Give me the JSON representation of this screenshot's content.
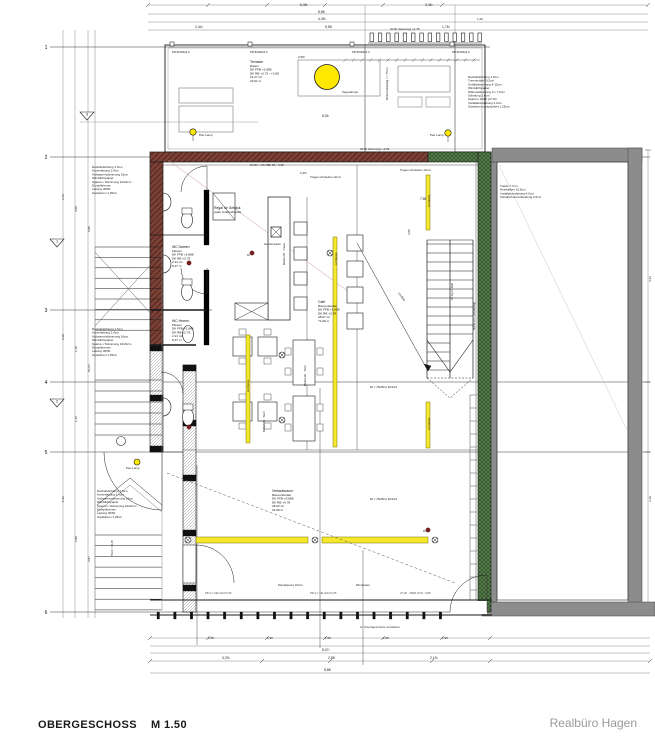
{
  "footer": {
    "sheet_title": "OBERGESCHOSS",
    "sheet_scale": "M 1.50",
    "firm": "Realbüro Hagen"
  },
  "colors": {
    "yellow": "#f5e82e",
    "lamp_yellow": "#ffe800",
    "brick": "#7c4136",
    "green": "#5b824f",
    "wall_gray": "#8c8c8c",
    "red_dot": "#7a1f1f"
  },
  "axis_rows": [
    {
      "n": "1",
      "y": 47,
      "x1": 50,
      "x2": 490
    },
    {
      "n": "2",
      "y": 157,
      "x1": 50,
      "x2": 650
    },
    {
      "n": "3",
      "y": 310,
      "x1": 50,
      "x2": 212
    },
    {
      "n": "4",
      "y": 382,
      "x1": 50,
      "x2": 650
    },
    {
      "n": "5",
      "y": 452,
      "x1": 50,
      "x2": 650
    },
    {
      "n": "6",
      "y": 612,
      "x1": 50,
      "x2": 650
    }
  ],
  "detail_markers": [
    {
      "n": "3",
      "x": 87,
      "y": 116
    },
    {
      "n": "1",
      "x": 57,
      "y": 243
    },
    {
      "n": "2",
      "x": 57,
      "y": 403
    }
  ],
  "room_stamps": [
    {
      "x": 250,
      "y": 63,
      "lines": [
        "Terrasse",
        "Dielen",
        "DK FFB +2.888",
        "DK RB +2.73 - +2.88",
        "21.27 m²",
        "22.01 m"
      ]
    },
    {
      "x": 172,
      "y": 248,
      "lines": [
        "WC Damen",
        "Fliesen",
        "DK FFB +2.888",
        "DK RB +2.79",
        "2.21 m²",
        "8.27 m"
      ]
    },
    {
      "x": 172,
      "y": 322,
      "lines": [
        "WC Herren",
        "Fliesen",
        "DK FFB +2.888",
        "DK RB +2.79",
        "2.21 m²",
        "8.27 m"
      ]
    },
    {
      "x": 318,
      "y": 303,
      "lines": [
        "Café",
        "Riemenboden",
        "DK FFB +2.888",
        "DK RB +2.79",
        "48.07 m²",
        "71.06 m"
      ]
    },
    {
      "x": 272,
      "y": 492,
      "lines": [
        "Verkaufsraum",
        "Riemenboden",
        "DK FFB +0.888",
        "DK RB +0.78",
        "28.22 m²",
        "31.90 m"
      ]
    },
    {
      "x": 214,
      "y": 209,
      "lines": [
        "Regal für Gebäck",
        "(statt Unterschrank)"
      ]
    }
  ],
  "spec_blocks": [
    {
      "x": 92,
      "y": 168,
      "lines": [
        "Dachabdichtung 1,5cm",
        "Konterlattung 2,4cm",
        "Aufsparrendämmung 16cm",
        "Winddichtpapier",
        "Sparren / Dämmung 10/22cm",
        "Dampfbremse",
        "Lattung 30/50",
        "Gipskarton 1,25cm"
      ]
    },
    {
      "x": 92,
      "y": 330,
      "lines": [
        "Dachabdichtung 1,5cm",
        "Konterlattung 2,4cm",
        "Aufsparrendämmung 16cm",
        "Winddichtpapier",
        "Sparren / Dämmung 10/22cm",
        "Dampfbremse",
        "Lattung 30/50",
        "Gipskarton 1,25cm"
      ]
    },
    {
      "x": 97,
      "y": 492,
      "lines": [
        "Dachabdichtung 1,5cm",
        "Konterlattung 2,4cm",
        "Aufsparrendämmung 16cm",
        "Winddichtpapier",
        "Sparren / Dämmung 10/22cm",
        "Dampfbremse",
        "Lattung 30/50",
        "Gipskarton 1,25cm"
      ]
    },
    {
      "x": 468,
      "y": 78,
      "lines": [
        "Dachabdichtung 1,5cm",
        "Trennschicht 0,2cm",
        "Gefälledämmung 4-12cm",
        "Winddichtpapier",
        "Wärmedämmung 2 x 7,0cm",
        "Schalung 2,4cm",
        "Sparren 10/20 (e=70)",
        "Installationslattung 4,0cm",
        "Gipskarton gespachtelt 1,25cm"
      ]
    },
    {
      "x": 500,
      "y": 187,
      "lines": [
        "Traufe 7,7cm",
        "Holzbalken 10,5cm",
        "Installationslattung 4,0cm",
        "Schallschutzverkleidung 2,5cm"
      ]
    }
  ],
  "labels": [
    {
      "t": "5,38¹",
      "x": 300,
      "y": 6,
      "s": 3.4
    },
    {
      "t": "3,46¹",
      "x": 425,
      "y": 6,
      "s": 3.4
    },
    {
      "t": "8,86",
      "x": 318,
      "y": 13,
      "s": 3.4
    },
    {
      "t": "4,05¹",
      "x": 318,
      "y": 20,
      "s": 3.4
    },
    {
      "t": "1,20",
      "x": 477,
      "y": 20,
      "s": 3
    },
    {
      "t": "2,44¹",
      "x": 195,
      "y": 28,
      "s": 3.4
    },
    {
      "t": "5,58",
      "x": 325,
      "y": 28,
      "s": 3.4
    },
    {
      "t": "1,76¹",
      "x": 442,
      "y": 28,
      "s": 3.4
    },
    {
      "t": "20 RI (Setzung) +2,78",
      "x": 390,
      "y": 30,
      "s": 3
    },
    {
      "t": "PR 80x80x2.0",
      "x": 172,
      "y": 53,
      "s": 2.8
    },
    {
      "t": "PR 80x80x2.0",
      "x": 250,
      "y": 53,
      "s": 2.8
    },
    {
      "t": "PR 80x80x2.0",
      "x": 352,
      "y": 53,
      "s": 2.8
    },
    {
      "t": "PR 80x80x2.0",
      "x": 452,
      "y": 53,
      "s": 2.8
    },
    {
      "t": "2,58¹",
      "x": 298,
      "y": 58,
      "s": 3
    },
    {
      "t": "Tageslampe",
      "x": 342,
      "y": 93,
      "s": 3
    },
    {
      "t": "Pan Lamp",
      "x": 199,
      "y": 136,
      "s": 3
    },
    {
      "t": "Pan Lamp",
      "x": 430,
      "y": 136,
      "s": 3
    },
    {
      "t": "8,34¹",
      "x": 322,
      "y": 117,
      "s": 3.2
    },
    {
      "t": "Möbel beidseitig h = 75cm",
      "x": 388,
      "y": 100,
      "r": -90,
      "s": 2.8
    },
    {
      "t": "20 RI (Setzung) +2,82",
      "x": 360,
      "y": 150,
      "s": 3
    },
    {
      "t": "DI DK = OK OBF 25 = 6,58",
      "x": 250,
      "y": 166,
      "s": 2.8
    },
    {
      "t": "Tragen schrauben 12mm",
      "x": 310,
      "y": 178,
      "s": 2.8
    },
    {
      "t": "Tragen schrauben 12mm",
      "x": 400,
      "y": 171,
      "s": 2.8
    },
    {
      "t": "2,25¹",
      "x": 300,
      "y": 174,
      "s": 3
    },
    {
      "t": "7,58",
      "x": 420,
      "y": 200,
      "s": 3.2
    },
    {
      "t": "3,05",
      "x": 410,
      "y": 235,
      "r": -90,
      "s": 3
    },
    {
      "t": "Geschirrspüler",
      "x": 264,
      "y": 245,
      "s": 2.6
    },
    {
      "t": "Lauflinie",
      "x": 398,
      "y": 293,
      "r": 55,
      "s": 2.8
    },
    {
      "t": "Möbel 2D - Theke",
      "x": 285,
      "y": 265,
      "r": -90,
      "s": 2.8
    },
    {
      "t": "Lichtleiste",
      "x": 337,
      "y": 265,
      "r": -90,
      "s": 2.8
    },
    {
      "t": "Lichtleiste",
      "x": 430,
      "y": 207,
      "r": -90,
      "s": 2.8
    },
    {
      "t": "Lichtleiste",
      "x": 430,
      "y": 430,
      "r": -90,
      "s": 2.8
    },
    {
      "t": "Lichtleiste",
      "x": 249,
      "y": 392,
      "r": -90,
      "s": 2.8
    },
    {
      "t": "Möbel 2D - Tisch",
      "x": 306,
      "y": 386,
      "r": -90,
      "s": 2.8
    },
    {
      "t": "Möbel 2D - Tisch",
      "x": 265,
      "y": 432,
      "r": -90,
      "s": 2.8
    },
    {
      "t": "18 Stg 17,5/28",
      "x": 453,
      "y": 300,
      "r": -90,
      "s": 2.6
    },
    {
      "t": "Mörtel 10 lt. (Werkseitig)",
      "x": 475,
      "y": 330,
      "r": -90,
      "s": 2.6
    },
    {
      "t": "60 × 15/28cm 90/14/1",
      "x": 370,
      "y": 388,
      "s": 2.8
    },
    {
      "t": "60 × 15/28cm 90/14/1",
      "x": 370,
      "y": 500,
      "s": 2.8
    },
    {
      "t": "Pan Lamp",
      "x": 126,
      "y": 469,
      "s": 3
    },
    {
      "t": "5% R = 10,05",
      "x": 113,
      "y": 556,
      "r": -90,
      "s": 2.6
    },
    {
      "t": "60",
      "x": 247,
      "y": 256,
      "s": 2.4
    },
    {
      "t": "60",
      "x": 423,
      "y": 532,
      "s": 2.4
    },
    {
      "t": "Dampfsperre 10mm",
      "x": 278,
      "y": 586,
      "s": 2.8
    },
    {
      "t": "Rinnkasten",
      "x": 356,
      "y": 586,
      "s": 2.8
    },
    {
      "t": "PR st = 101.0x0.0 0.05",
      "x": 205,
      "y": 594,
      "s": 2.6,
      "c": "#444"
    },
    {
      "t": "PR st = 101.0x0.0 0.05",
      "x": 310,
      "y": 594,
      "s": 2.6,
      "c": "#444"
    },
    {
      "t": "27 UK - 25/05 N UK - 5,88",
      "x": 400,
      "y": 594,
      "s": 2.6,
      "c": "#444"
    },
    {
      "t": "im Kriechgeschoss verstärken",
      "x": 360,
      "y": 628,
      "s": 3,
      "c": "#333"
    },
    {
      "t": "1,55",
      "x": 208,
      "y": 639,
      "s": 3
    },
    {
      "t": "1,55",
      "x": 267,
      "y": 639,
      "s": 3
    },
    {
      "t": "1,55",
      "x": 325,
      "y": 639,
      "s": 3
    },
    {
      "t": "1,55",
      "x": 383,
      "y": 639,
      "s": 3
    },
    {
      "t": "1,55",
      "x": 442,
      "y": 639,
      "s": 3
    },
    {
      "t": "8,07¹",
      "x": 322,
      "y": 651,
      "s": 3.4
    },
    {
      "t": "3,29¹",
      "x": 222,
      "y": 659,
      "s": 3.4
    },
    {
      "t": "2,88",
      "x": 328,
      "y": 659,
      "s": 3.4
    },
    {
      "t": "2,19¹",
      "x": 430,
      "y": 659,
      "s": 3.4
    },
    {
      "t": "8,88",
      "x": 324,
      "y": 671,
      "s": 3.4
    },
    {
      "t": "3,72",
      "x": 64,
      "y": 200,
      "r": -90,
      "s": 3
    },
    {
      "t": "3,58",
      "x": 77,
      "y": 212,
      "r": -90,
      "s": 3
    },
    {
      "t": "6,88",
      "x": 90,
      "y": 232,
      "r": -90,
      "s": 3
    },
    {
      "t": "3,18",
      "x": 64,
      "y": 340,
      "r": -90,
      "s": 3
    },
    {
      "t": "1,18",
      "x": 77,
      "y": 352,
      "r": -90,
      "s": 3
    },
    {
      "t": "10,63",
      "x": 90,
      "y": 372,
      "r": -90,
      "s": 3
    },
    {
      "t": "1,15",
      "x": 77,
      "y": 422,
      "r": -90,
      "s": 3
    },
    {
      "t": "1,62",
      "x": 64,
      "y": 502,
      "r": -90,
      "s": 3
    },
    {
      "t": "2,88",
      "x": 77,
      "y": 542,
      "r": -90,
      "s": 3
    },
    {
      "t": "3,87",
      "x": 90,
      "y": 562,
      "r": -90,
      "s": 3
    },
    {
      "t": "4,44",
      "x": 651,
      "y": 282,
      "r": -90,
      "s": 3
    },
    {
      "t": "3,19",
      "x": 651,
      "y": 502,
      "r": -90,
      "s": 3
    }
  ]
}
